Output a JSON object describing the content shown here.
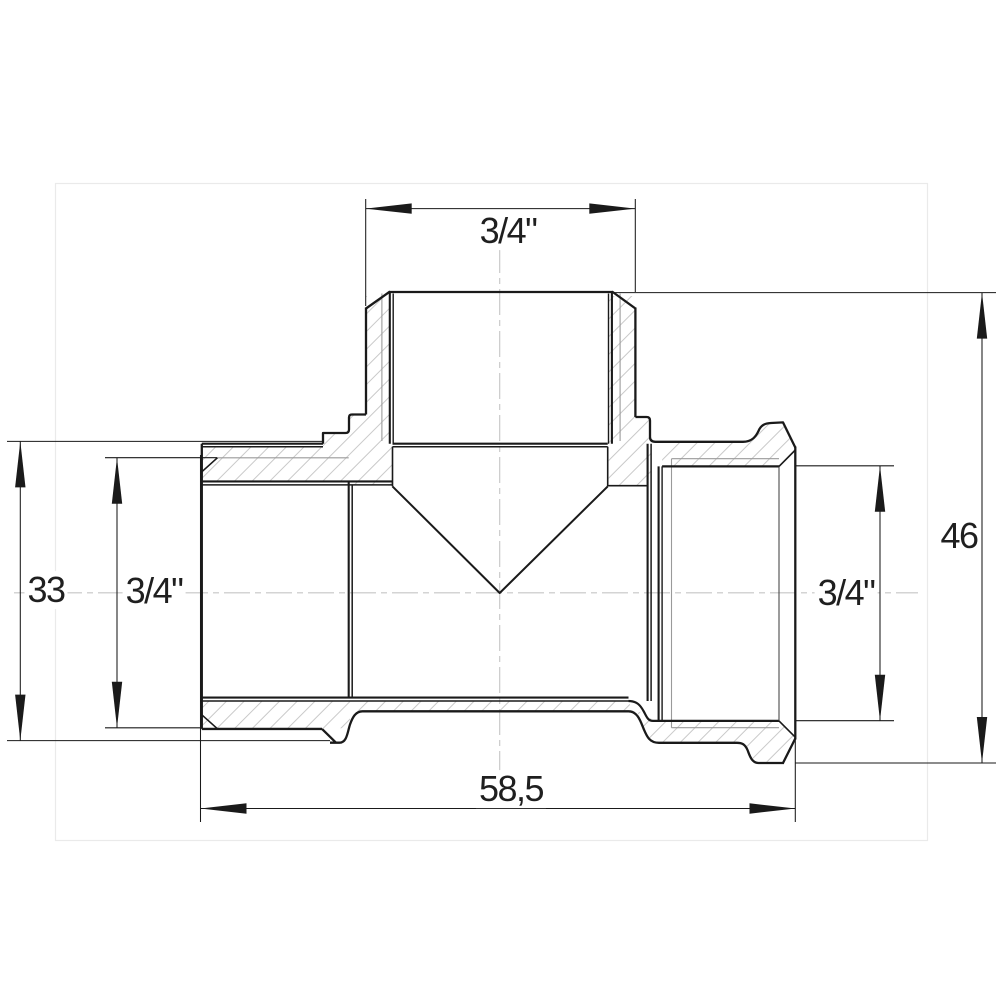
{
  "drawing": {
    "title": "Tee fitting section drawing",
    "view": "front-section",
    "dimensions": {
      "top_thread": {
        "label": "3/4\"",
        "position": "top"
      },
      "left_outer": {
        "label": "33",
        "position": "left"
      },
      "left_thread": {
        "label": "3/4\"",
        "position": "left-inner"
      },
      "right_thread": {
        "label": "3/4\"",
        "position": "right-inner"
      },
      "right_outer": {
        "label": "46",
        "position": "right"
      },
      "overall_length": {
        "label": "58,5",
        "position": "bottom"
      }
    },
    "colors": {
      "outline": "#1a1a1a",
      "thin_line": "#3a3a3a",
      "thread_line": "#9a9a9a",
      "hatch": "#c9c9c9",
      "centerline": "#c5c5c5",
      "frame": "#eaeaea",
      "background": "#ffffff",
      "text": "#1f1f1f"
    }
  }
}
